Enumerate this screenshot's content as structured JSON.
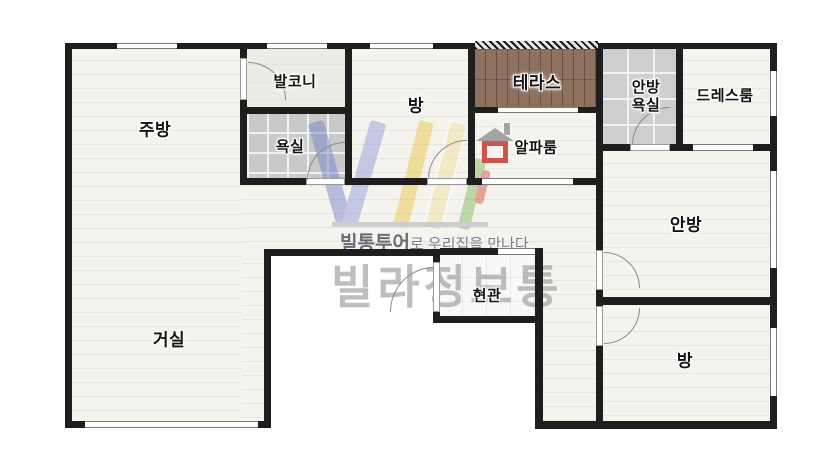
{
  "rooms": {
    "kitchen": {
      "label": "주방"
    },
    "balcony": {
      "label": "발코니"
    },
    "bathroom": {
      "label": "욕실"
    },
    "bedroom_top": {
      "label": "방"
    },
    "terrace": {
      "label": "테라스"
    },
    "alpha_room": {
      "label": "알파룸"
    },
    "master_bathroom": {
      "line1": "안방",
      "line2": "욕실"
    },
    "dress_room": {
      "label": "드레스룸"
    },
    "master_bedroom": {
      "label": "안방"
    },
    "living_room": {
      "label": "거실"
    },
    "entrance": {
      "label": "현관"
    },
    "bedroom_bottom": {
      "label": "방"
    }
  },
  "watermark": {
    "tagline_bold": "빌통투어",
    "tagline_rest": "로 우리집을 만나다",
    "brand": "빌라정보통"
  },
  "colors": {
    "wall": "#1e1e1e",
    "floor": "#f4f3ee",
    "bathroom_tile": "#c9c9c9",
    "terrace_wood": "#8d7260",
    "balcony_floor": "#edebe6",
    "entrance_tile": "#f8f8f6",
    "logo_blue": "#6b7cc9",
    "logo_yellow": "#eac33f",
    "logo_green": "#7cb44e",
    "logo_red": "#cf4433",
    "brand_gray": "#969696"
  }
}
